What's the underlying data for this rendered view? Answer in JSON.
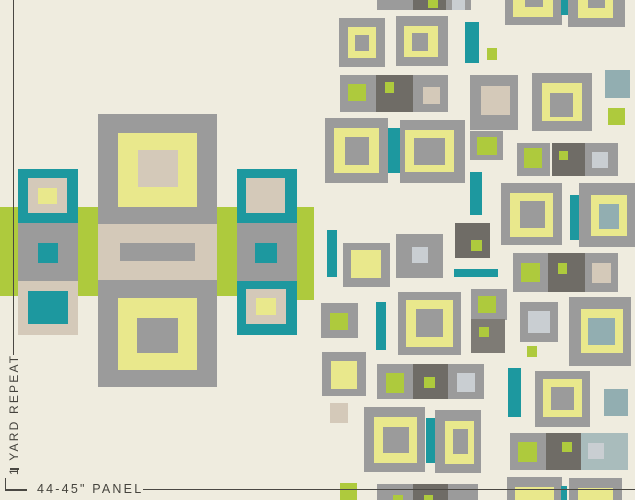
{
  "palette": {
    "cream": "#efecdf",
    "gray": "#9b9b9b",
    "grayDark": "#6f6c66",
    "grayDeep": "#7e7b75",
    "yellow": "#e9e88c",
    "green": "#aeca3d",
    "teal": "#1d989f",
    "tan": "#d4c9b9",
    "silver": "#c9ced2",
    "slate": "#92aeb1",
    "slateLight": "#a9bcbc",
    "ink": "#45433d"
  },
  "labels": {
    "yard_repeat": "1 YARD REPEAT",
    "panel": "44-45\" PANEL"
  },
  "layers": {
    "left_motif": [
      {
        "x": 0,
        "y": 207,
        "w": 297,
        "h": 89,
        "c": "green"
      },
      {
        "x": 297,
        "y": 207,
        "w": 17,
        "h": 93,
        "c": "green"
      },
      {
        "x": 98,
        "y": 114,
        "w": 119,
        "h": 110,
        "c": "gray"
      },
      {
        "x": 118,
        "y": 133,
        "w": 79,
        "h": 74,
        "c": "yellow"
      },
      {
        "x": 138,
        "y": 150,
        "w": 40,
        "h": 37,
        "c": "tan"
      },
      {
        "x": 98,
        "y": 224,
        "w": 119,
        "h": 56,
        "c": "tan"
      },
      {
        "x": 120,
        "y": 243,
        "w": 75,
        "h": 18,
        "c": "gray"
      },
      {
        "x": 98,
        "y": 280,
        "w": 119,
        "h": 107,
        "c": "gray"
      },
      {
        "x": 118,
        "y": 298,
        "w": 79,
        "h": 72,
        "c": "yellow"
      },
      {
        "x": 137,
        "y": 318,
        "w": 41,
        "h": 35,
        "c": "gray"
      },
      {
        "x": 18,
        "y": 169,
        "w": 60,
        "h": 54,
        "c": "teal"
      },
      {
        "x": 28,
        "y": 178,
        "w": 39,
        "h": 35,
        "c": "tan"
      },
      {
        "x": 38,
        "y": 188,
        "w": 19,
        "h": 16,
        "c": "yellow"
      },
      {
        "x": 18,
        "y": 223,
        "w": 60,
        "h": 58,
        "c": "gray"
      },
      {
        "x": 38,
        "y": 243,
        "w": 20,
        "h": 20,
        "c": "teal"
      },
      {
        "x": 18,
        "y": 281,
        "w": 60,
        "h": 54,
        "c": "tan"
      },
      {
        "x": 28,
        "y": 291,
        "w": 40,
        "h": 33,
        "c": "teal"
      },
      {
        "x": 237,
        "y": 169,
        "w": 60,
        "h": 54,
        "c": "teal"
      },
      {
        "x": 246,
        "y": 178,
        "w": 39,
        "h": 35,
        "c": "tan"
      },
      {
        "x": 237,
        "y": 223,
        "w": 60,
        "h": 58,
        "c": "gray"
      },
      {
        "x": 255,
        "y": 243,
        "w": 22,
        "h": 20,
        "c": "teal"
      },
      {
        "x": 237,
        "y": 281,
        "w": 60,
        "h": 54,
        "c": "teal"
      },
      {
        "x": 246,
        "y": 289,
        "w": 40,
        "h": 35,
        "c": "tan"
      },
      {
        "x": 256,
        "y": 298,
        "w": 20,
        "h": 17,
        "c": "yellow"
      }
    ],
    "pattern": [
      {
        "x": 377,
        "y": 0,
        "w": 36,
        "h": 10,
        "c": "gray"
      },
      {
        "x": 413,
        "y": 0,
        "w": 33,
        "h": 10,
        "c": "grayDark"
      },
      {
        "x": 428,
        "y": 0,
        "w": 10,
        "h": 8,
        "c": "green"
      },
      {
        "x": 446,
        "y": 0,
        "w": 25,
        "h": 10,
        "c": "gray"
      },
      {
        "x": 452,
        "y": 0,
        "w": 13,
        "h": 10,
        "c": "silver"
      },
      {
        "x": 505,
        "y": 0,
        "w": 57,
        "h": 25,
        "c": "gray"
      },
      {
        "x": 513,
        "y": 0,
        "w": 40,
        "h": 17,
        "c": "yellow"
      },
      {
        "x": 525,
        "y": 0,
        "w": 18,
        "h": 7,
        "c": "gray"
      },
      {
        "x": 561,
        "y": 0,
        "w": 9,
        "h": 15,
        "c": "teal"
      },
      {
        "x": 568,
        "y": 0,
        "w": 57,
        "h": 27,
        "c": "gray"
      },
      {
        "x": 578,
        "y": 0,
        "w": 35,
        "h": 18,
        "c": "yellow"
      },
      {
        "x": 588,
        "y": 0,
        "w": 17,
        "h": 8,
        "c": "gray"
      },
      {
        "x": 339,
        "y": 18,
        "w": 46,
        "h": 49,
        "c": "gray"
      },
      {
        "x": 348,
        "y": 27,
        "w": 28,
        "h": 31,
        "c": "yellow"
      },
      {
        "x": 355,
        "y": 35,
        "w": 14,
        "h": 16,
        "c": "gray"
      },
      {
        "x": 396,
        "y": 16,
        "w": 52,
        "h": 50,
        "c": "gray"
      },
      {
        "x": 404,
        "y": 26,
        "w": 34,
        "h": 31,
        "c": "yellow"
      },
      {
        "x": 412,
        "y": 33,
        "w": 16,
        "h": 18,
        "c": "gray"
      },
      {
        "x": 465,
        "y": 22,
        "w": 14,
        "h": 41,
        "c": "teal"
      },
      {
        "x": 487,
        "y": 48,
        "w": 10,
        "h": 12,
        "c": "green"
      },
      {
        "x": 340,
        "y": 75,
        "w": 36,
        "h": 37,
        "c": "gray"
      },
      {
        "x": 348,
        "y": 84,
        "w": 18,
        "h": 17,
        "c": "green"
      },
      {
        "x": 376,
        "y": 75,
        "w": 37,
        "h": 37,
        "c": "grayDark"
      },
      {
        "x": 385,
        "y": 82,
        "w": 9,
        "h": 11,
        "c": "green"
      },
      {
        "x": 413,
        "y": 75,
        "w": 35,
        "h": 37,
        "c": "gray"
      },
      {
        "x": 423,
        "y": 87,
        "w": 17,
        "h": 17,
        "c": "tan"
      },
      {
        "x": 470,
        "y": 75,
        "w": 48,
        "h": 55,
        "c": "gray"
      },
      {
        "x": 481,
        "y": 86,
        "w": 29,
        "h": 29,
        "c": "tan"
      },
      {
        "x": 532,
        "y": 73,
        "w": 60,
        "h": 58,
        "c": "gray"
      },
      {
        "x": 542,
        "y": 83,
        "w": 40,
        "h": 38,
        "c": "yellow"
      },
      {
        "x": 550,
        "y": 93,
        "w": 23,
        "h": 24,
        "c": "gray"
      },
      {
        "x": 605,
        "y": 70,
        "w": 25,
        "h": 28,
        "c": "slate"
      },
      {
        "x": 608,
        "y": 108,
        "w": 17,
        "h": 17,
        "c": "green"
      },
      {
        "x": 325,
        "y": 118,
        "w": 63,
        "h": 65,
        "c": "gray"
      },
      {
        "x": 334,
        "y": 128,
        "w": 45,
        "h": 45,
        "c": "yellow"
      },
      {
        "x": 345,
        "y": 137,
        "w": 24,
        "h": 28,
        "c": "gray"
      },
      {
        "x": 388,
        "y": 128,
        "w": 12,
        "h": 45,
        "c": "teal"
      },
      {
        "x": 400,
        "y": 120,
        "w": 65,
        "h": 63,
        "c": "gray"
      },
      {
        "x": 405,
        "y": 130,
        "w": 49,
        "h": 42,
        "c": "yellow"
      },
      {
        "x": 414,
        "y": 138,
        "w": 31,
        "h": 27,
        "c": "gray"
      },
      {
        "x": 470,
        "y": 131,
        "w": 33,
        "h": 29,
        "c": "gray"
      },
      {
        "x": 477,
        "y": 137,
        "w": 20,
        "h": 18,
        "c": "green"
      },
      {
        "x": 517,
        "y": 143,
        "w": 33,
        "h": 33,
        "c": "gray"
      },
      {
        "x": 524,
        "y": 148,
        "w": 18,
        "h": 20,
        "c": "green"
      },
      {
        "x": 552,
        "y": 143,
        "w": 33,
        "h": 33,
        "c": "grayDark"
      },
      {
        "x": 559,
        "y": 151,
        "w": 9,
        "h": 9,
        "c": "green"
      },
      {
        "x": 585,
        "y": 143,
        "w": 33,
        "h": 33,
        "c": "gray"
      },
      {
        "x": 592,
        "y": 152,
        "w": 16,
        "h": 16,
        "c": "silver"
      },
      {
        "x": 470,
        "y": 172,
        "w": 12,
        "h": 43,
        "c": "teal"
      },
      {
        "x": 501,
        "y": 183,
        "w": 61,
        "h": 62,
        "c": "gray"
      },
      {
        "x": 510,
        "y": 193,
        "w": 43,
        "h": 44,
        "c": "yellow"
      },
      {
        "x": 520,
        "y": 201,
        "w": 25,
        "h": 27,
        "c": "gray"
      },
      {
        "x": 570,
        "y": 195,
        "w": 9,
        "h": 45,
        "c": "teal"
      },
      {
        "x": 579,
        "y": 183,
        "w": 56,
        "h": 64,
        "c": "gray"
      },
      {
        "x": 591,
        "y": 195,
        "w": 36,
        "h": 41,
        "c": "yellow"
      },
      {
        "x": 599,
        "y": 204,
        "w": 20,
        "h": 25,
        "c": "slate"
      },
      {
        "x": 455,
        "y": 223,
        "w": 35,
        "h": 35,
        "c": "grayDark"
      },
      {
        "x": 471,
        "y": 240,
        "w": 11,
        "h": 11,
        "c": "green"
      },
      {
        "x": 327,
        "y": 230,
        "w": 10,
        "h": 47,
        "c": "teal"
      },
      {
        "x": 343,
        "y": 243,
        "w": 47,
        "h": 44,
        "c": "gray"
      },
      {
        "x": 351,
        "y": 250,
        "w": 30,
        "h": 28,
        "c": "yellow"
      },
      {
        "x": 396,
        "y": 234,
        "w": 47,
        "h": 44,
        "c": "gray"
      },
      {
        "x": 412,
        "y": 247,
        "w": 16,
        "h": 16,
        "c": "silver"
      },
      {
        "x": 454,
        "y": 269,
        "w": 44,
        "h": 8,
        "c": "teal"
      },
      {
        "x": 513,
        "y": 253,
        "w": 35,
        "h": 39,
        "c": "gray"
      },
      {
        "x": 521,
        "y": 263,
        "w": 19,
        "h": 19,
        "c": "green"
      },
      {
        "x": 548,
        "y": 253,
        "w": 37,
        "h": 39,
        "c": "grayDark"
      },
      {
        "x": 558,
        "y": 263,
        "w": 9,
        "h": 11,
        "c": "green"
      },
      {
        "x": 585,
        "y": 253,
        "w": 33,
        "h": 39,
        "c": "gray"
      },
      {
        "x": 592,
        "y": 263,
        "w": 19,
        "h": 20,
        "c": "tan"
      },
      {
        "x": 471,
        "y": 289,
        "w": 36,
        "h": 31,
        "c": "gray"
      },
      {
        "x": 478,
        "y": 296,
        "w": 18,
        "h": 17,
        "c": "green"
      },
      {
        "x": 471,
        "y": 319,
        "w": 34,
        "h": 34,
        "c": "grayDeep"
      },
      {
        "x": 479,
        "y": 327,
        "w": 10,
        "h": 10,
        "c": "green"
      },
      {
        "x": 520,
        "y": 302,
        "w": 38,
        "h": 40,
        "c": "gray"
      },
      {
        "x": 528,
        "y": 311,
        "w": 22,
        "h": 22,
        "c": "silver"
      },
      {
        "x": 527,
        "y": 346,
        "w": 10,
        "h": 11,
        "c": "green"
      },
      {
        "x": 569,
        "y": 297,
        "w": 62,
        "h": 69,
        "c": "gray"
      },
      {
        "x": 581,
        "y": 309,
        "w": 42,
        "h": 44,
        "c": "yellow"
      },
      {
        "x": 588,
        "y": 318,
        "w": 27,
        "h": 27,
        "c": "slate"
      },
      {
        "x": 321,
        "y": 303,
        "w": 37,
        "h": 35,
        "c": "gray"
      },
      {
        "x": 330,
        "y": 313,
        "w": 18,
        "h": 17,
        "c": "green"
      },
      {
        "x": 376,
        "y": 302,
        "w": 10,
        "h": 48,
        "c": "teal"
      },
      {
        "x": 398,
        "y": 292,
        "w": 63,
        "h": 63,
        "c": "gray"
      },
      {
        "x": 406,
        "y": 300,
        "w": 47,
        "h": 47,
        "c": "yellow"
      },
      {
        "x": 416,
        "y": 309,
        "w": 27,
        "h": 28,
        "c": "gray"
      },
      {
        "x": 322,
        "y": 352,
        "w": 44,
        "h": 44,
        "c": "gray"
      },
      {
        "x": 331,
        "y": 361,
        "w": 26,
        "h": 28,
        "c": "yellow"
      },
      {
        "x": 330,
        "y": 403,
        "w": 18,
        "h": 20,
        "c": "tan"
      },
      {
        "x": 377,
        "y": 364,
        "w": 36,
        "h": 35,
        "c": "gray"
      },
      {
        "x": 386,
        "y": 373,
        "w": 18,
        "h": 20,
        "c": "green"
      },
      {
        "x": 413,
        "y": 364,
        "w": 35,
        "h": 35,
        "c": "grayDark"
      },
      {
        "x": 424,
        "y": 377,
        "w": 11,
        "h": 11,
        "c": "green"
      },
      {
        "x": 448,
        "y": 364,
        "w": 36,
        "h": 35,
        "c": "gray"
      },
      {
        "x": 457,
        "y": 373,
        "w": 18,
        "h": 19,
        "c": "silver"
      },
      {
        "x": 508,
        "y": 368,
        "w": 13,
        "h": 49,
        "c": "teal"
      },
      {
        "x": 535,
        "y": 371,
        "w": 55,
        "h": 56,
        "c": "gray"
      },
      {
        "x": 543,
        "y": 379,
        "w": 39,
        "h": 38,
        "c": "yellow"
      },
      {
        "x": 551,
        "y": 387,
        "w": 23,
        "h": 23,
        "c": "gray"
      },
      {
        "x": 604,
        "y": 389,
        "w": 24,
        "h": 27,
        "c": "slate"
      },
      {
        "x": 364,
        "y": 407,
        "w": 61,
        "h": 65,
        "c": "gray"
      },
      {
        "x": 374,
        "y": 417,
        "w": 43,
        "h": 46,
        "c": "yellow"
      },
      {
        "x": 383,
        "y": 427,
        "w": 26,
        "h": 26,
        "c": "gray"
      },
      {
        "x": 426,
        "y": 418,
        "w": 10,
        "h": 45,
        "c": "teal"
      },
      {
        "x": 435,
        "y": 410,
        "w": 46,
        "h": 63,
        "c": "gray"
      },
      {
        "x": 445,
        "y": 421,
        "w": 29,
        "h": 43,
        "c": "yellow"
      },
      {
        "x": 453,
        "y": 429,
        "w": 15,
        "h": 25,
        "c": "gray"
      },
      {
        "x": 510,
        "y": 433,
        "w": 36,
        "h": 37,
        "c": "gray"
      },
      {
        "x": 518,
        "y": 442,
        "w": 19,
        "h": 20,
        "c": "green"
      },
      {
        "x": 546,
        "y": 433,
        "w": 35,
        "h": 37,
        "c": "grayDark"
      },
      {
        "x": 562,
        "y": 442,
        "w": 10,
        "h": 10,
        "c": "green"
      },
      {
        "x": 581,
        "y": 433,
        "w": 47,
        "h": 37,
        "c": "slateLight"
      },
      {
        "x": 588,
        "y": 443,
        "w": 16,
        "h": 16,
        "c": "silver"
      },
      {
        "x": 340,
        "y": 483,
        "w": 17,
        "h": 17,
        "c": "green"
      },
      {
        "x": 377,
        "y": 484,
        "w": 36,
        "h": 16,
        "c": "gray"
      },
      {
        "x": 393,
        "y": 495,
        "w": 10,
        "h": 5,
        "c": "green"
      },
      {
        "x": 413,
        "y": 484,
        "w": 35,
        "h": 16,
        "c": "grayDark"
      },
      {
        "x": 424,
        "y": 495,
        "w": 9,
        "h": 5,
        "c": "green"
      },
      {
        "x": 448,
        "y": 484,
        "w": 30,
        "h": 16,
        "c": "gray"
      },
      {
        "x": 507,
        "y": 477,
        "w": 55,
        "h": 23,
        "c": "gray"
      },
      {
        "x": 515,
        "y": 487,
        "w": 39,
        "h": 13,
        "c": "yellow"
      },
      {
        "x": 561,
        "y": 486,
        "w": 6,
        "h": 14,
        "c": "teal"
      },
      {
        "x": 569,
        "y": 478,
        "w": 53,
        "h": 22,
        "c": "gray"
      },
      {
        "x": 578,
        "y": 488,
        "w": 35,
        "h": 12,
        "c": "yellow"
      }
    ]
  }
}
